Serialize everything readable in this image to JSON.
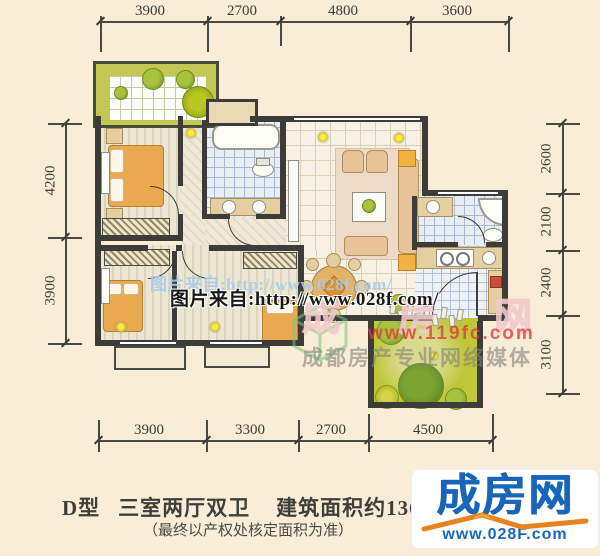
{
  "dimensions": {
    "top": [
      "3900",
      "2700",
      "4800",
      "3600"
    ],
    "bottom": [
      "3900",
      "3300",
      "2700",
      "4500"
    ],
    "left": [
      "4200",
      "3900"
    ],
    "right": [
      "2600",
      "2100",
      "2400",
      "3100"
    ]
  },
  "watermarks": {
    "photo_credit_light": "图片来自:http://www.028f.com/",
    "photo_credit_dark": "图片来自:http://www.028f.com/",
    "brand_outline": "成房网",
    "url_red": "www.119fc.com",
    "media_slogan": "成都房产专业网络媒体"
  },
  "footer": {
    "unit_type": "D型",
    "layout": "三室两厅双卫",
    "area_prefix": "建筑面积约136m",
    "area_sup": "2",
    "note": "（最终以产权处核定面积为准）"
  },
  "logo": {
    "brand": "成房网",
    "url": "www.028F.com",
    "brand_color": "#1866ba",
    "swoosh_color": "#e8821e"
  },
  "colors": {
    "background": "#f9edd7",
    "wall": "#3e3c38",
    "garden": "#bfc737",
    "bed": "#eba94f"
  }
}
